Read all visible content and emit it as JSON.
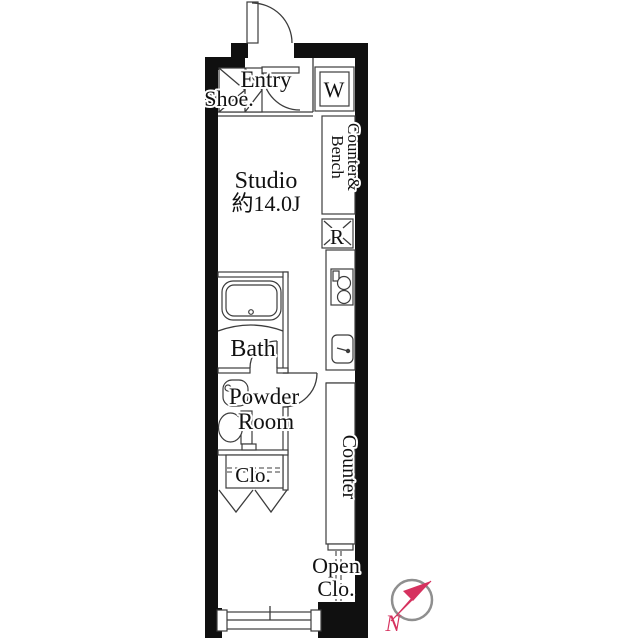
{
  "plan": {
    "labels": {
      "entry": "Entry",
      "shoe": "Shoe.",
      "washer": "W",
      "counter_bench_1": "Counter&",
      "counter_bench_2": "Bench",
      "studio": "Studio",
      "studio_size": "約14.0J",
      "fridge": "R",
      "bath": "Bath",
      "powder_1": "Powder",
      "powder_2": "Room",
      "closet": "Clo.",
      "counter": "Counter",
      "open_closet_1": "Open",
      "open_closet_2": "Clo.",
      "compass_north": "N"
    },
    "colors": {
      "wall": "#101010",
      "line": "#3c3c3c",
      "accent": "#d6325f",
      "compass_ring": "#8f8f8f",
      "background": "#ffffff"
    }
  }
}
